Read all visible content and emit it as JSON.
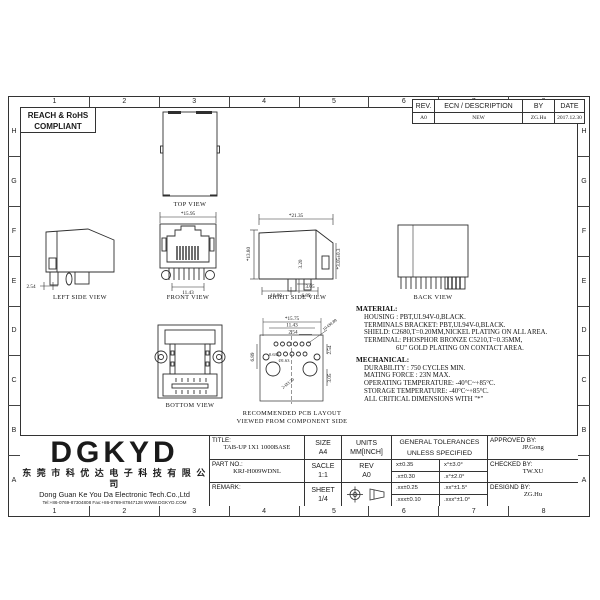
{
  "sheet": {
    "grid_columns": [
      "1",
      "2",
      "3",
      "4",
      "5",
      "6",
      "7",
      "8"
    ],
    "grid_rows": [
      "H",
      "G",
      "F",
      "E",
      "D",
      "C",
      "B",
      "A"
    ]
  },
  "compliance": {
    "line1": "REACH & RoHS",
    "line2": "COMPLIANT"
  },
  "revision_table": {
    "headers": [
      "REV.",
      "ECN / DESCRIPTION",
      "BY",
      "DATE"
    ],
    "rows": [
      [
        "A0",
        "NEW",
        "ZG.Hu",
        "2017.12.30"
      ]
    ]
  },
  "views": {
    "top": {
      "label": "TOP VIEW"
    },
    "left": {
      "label": "LEFT SIDE VIEW",
      "dim_254": "2.54"
    },
    "front": {
      "label": "FRONT VIEW",
      "dim_width": "*15.95",
      "dim_pins": "11.43",
      "dim_height": "*13.80"
    },
    "right": {
      "label": "RIGHT SIDE VIEW",
      "dim_width": "*21.35",
      "dim_320": "3.20",
      "dim_305tol": "*3.05±0.3",
      "dim_305": "3.05",
      "dim_689": "6.89",
      "dim_1080": "10.80"
    },
    "back": {
      "label": "BACK VIEW"
    },
    "bottom": {
      "label": "BOTTOM VIEW"
    },
    "pcb": {
      "label1": "RECOMMENDED PCB LAYOUT",
      "label2": "VIEWED FROM COMPONENT SIDE",
      "dim_1575": "*15.75",
      "dim_1143": "11.43",
      "dim_254": "2.54",
      "dim_holes": "10-Ø0.89",
      "dim_689": "6.89",
      "dim_0635": "0.635",
      "dim_163": "Ø1.63",
      "dim_320": "2-Ø3.20",
      "dim_305": "3.05",
      "dim_254r": "2.54"
    }
  },
  "material": {
    "heading": "MATERIAL:",
    "lines": [
      "HOUSING : PBT,UL94V-0,BLACK.",
      "TERMINALS BRACKET: PBT,UL94V-0,BLACK.",
      "SHIELD: C2680,T=0.20MM,NICKEL PLATING ON ALL AREA.",
      "TERMINAL: PHOSPHOR BRONZE C5210,T=0.35MM,",
      "6U\" GOLD PLATING ON CONTACT AREA."
    ]
  },
  "mechanical": {
    "heading": "MECHANICAL:",
    "lines": [
      "DURABILITY : 750 CYCLES MIN.",
      "MATING FORCE : 23N MAX.",
      "OPERATING TEMPERATURE: -40°C~+85°C.",
      "STORAGE TEMPERATURE: -40°C~+85°C.",
      "ALL CRITICAL DIMENSIONS WITH \"*\""
    ]
  },
  "company": {
    "logo": "DGKYD",
    "name_cn": "东 莞 市 科 优 达 电 子 科 技 有 限 公 司",
    "name_en": "Dong Guan Ke You Da Electronic Tech.Co.,Ltd",
    "contact": "Tel:+86-0769-87304808  Fax:+86-0769-87847128  WWW.DGKYD.COM"
  },
  "title_block": {
    "title_label": "TITLE:",
    "title_value": "TAB-UP 1X1 1000BASE",
    "part_label": "PART NO.:",
    "part_value": "KRJ-H009WDNL",
    "remark_label": "REMARK:",
    "size_label": "SIZE",
    "size_value": "A4",
    "scale_label": "SACLE",
    "scale_value": "1:1",
    "sheet_label": "SHEET",
    "sheet_value": "1/4",
    "units_label": "UNITS",
    "units_value": "MM[INCH]",
    "rev_label": "REV",
    "rev_value": "A0",
    "tol_header1": "GENERAL TOLERANCES",
    "tol_header2": "UNLESS SPECIFIED",
    "tolerances": [
      [
        "x±0.35",
        "x°±3.0°"
      ],
      [
        ".x±0.30",
        ".x°±2.0°"
      ],
      [
        ".xx±0.25",
        ".xx°±1.5°"
      ],
      [
        ".xxx±0.10",
        ".xxx°±1.0°"
      ]
    ],
    "approved_label": "APPROVED BY:",
    "approved_value": "JP.Gong",
    "checked_label": "CHECKED BY:",
    "checked_value": "TW.XU",
    "designed_label": "DESIGND BY:",
    "designed_value": "ZG.Hu"
  }
}
